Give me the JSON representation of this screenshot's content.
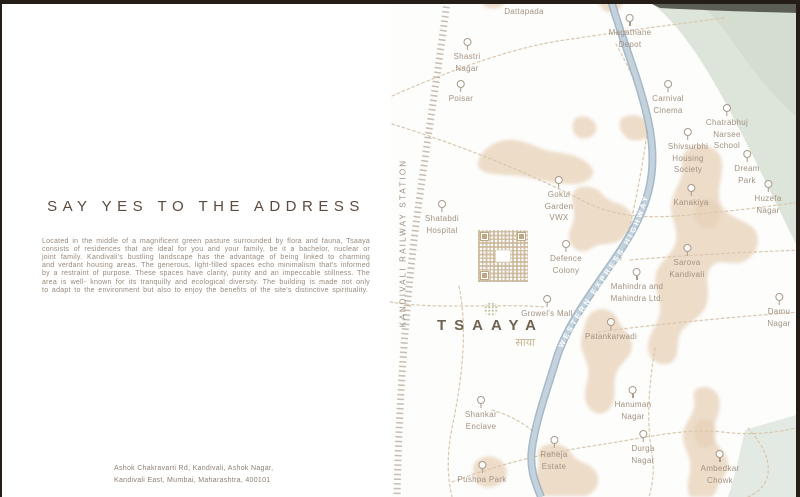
{
  "left_panel": {
    "heading": "SAY YES TO THE ADDRESS",
    "body": "Located in the middle of a magnificent green pasture surrounded by flora and fauna, Tsaaya consists of residences that are ideal for you and your family, be it a bachelor, nuclear or joint family. Kandivali's bustling landscape has the advantage of being linked to charming and verdant housing areas. The generous, light-filled spaces echo minimalism that's informed by a restraint of purpose. These spaces have clarity, purity and an impeccable stillness. The area is well- known for its tranquilly and ecological diversity. The building is made not only to adapt to the environment but also to enjoy the benefits of the site's distinctive spirituality.",
    "address_line1": "Ashok Chakravarti Rd, Kandivali, Ashok Nagar,",
    "address_line2": "Kandivali East, Mumbai, Maharashtra, 400101"
  },
  "map": {
    "station_label": "KANDIVALI RAILWAY STATION",
    "highway_label": "WESTERN EXPRESS HIGHWAY",
    "logo": {
      "name": "TSAAYA",
      "devanagari": "साया"
    },
    "icons": {
      "marker": "map-pin-icon",
      "qr": "qr-code",
      "tree": "tree-icon"
    },
    "colors": {
      "frame": "#241d18",
      "heading_text": "#5d4a3e",
      "body_text": "#98897c",
      "map_label": "#a39282",
      "road_dash": "#d9c7ae",
      "railway": "#b3a493",
      "highway_edge": "#8fa7ba",
      "highway_fill": "#c3d2dd",
      "land_patch": "#ead7c0",
      "park_green": "#dde4d9",
      "water_green": "#e2eae3"
    },
    "markers": [
      {
        "id": "dattapada",
        "label": "Dattapada"
      },
      {
        "id": "magathane-depot",
        "label": "Magathane\nDepot"
      },
      {
        "id": "shastri-nagar",
        "label": "Shastri\nNagar"
      },
      {
        "id": "poisar",
        "label": "Poisar"
      },
      {
        "id": "carnival-cinema",
        "label": "Carnival\nCinema"
      },
      {
        "id": "chatrabhuj-narsee-school",
        "label": "Chatrabhuj\nNarsee\nSchool"
      },
      {
        "id": "shivsurbhi-housing-society",
        "label": "Shivsurbhi\nHousing\nSociety"
      },
      {
        "id": "dream-park",
        "label": "Dream\nPark"
      },
      {
        "id": "kanakiya",
        "label": "Kanakiya"
      },
      {
        "id": "huzefa-nagar",
        "label": "Huzefa\nNagar"
      },
      {
        "id": "gokul-garden-vwx",
        "label": "Gokul\nGarden\nVWX"
      },
      {
        "id": "shatabdi-hospital",
        "label": "Shatabdi\nHospital"
      },
      {
        "id": "defence-colony",
        "label": "Defence\nColony"
      },
      {
        "id": "sarova-kandivali",
        "label": "Sarova\nKandivali"
      },
      {
        "id": "mahindra-and-mahindra",
        "label": "Mahindra and\nMahindra Ltd."
      },
      {
        "id": "damu-nagar",
        "label": "Damu\nNagar"
      },
      {
        "id": "growels-mall",
        "label": "Growel's Mall"
      },
      {
        "id": "patankarwadi",
        "label": "Patankarwadi"
      },
      {
        "id": "shankar-enclave",
        "label": "Shankar\nEnclave"
      },
      {
        "id": "hanuman-nagar",
        "label": "Hanuman\nNagar"
      },
      {
        "id": "raheja-estate",
        "label": "Raheja\nEstate"
      },
      {
        "id": "durga-nagar",
        "label": "Durga\nNagar"
      },
      {
        "id": "pushpa-park",
        "label": "Pushpa Park"
      },
      {
        "id": "ambedkar-chowk",
        "label": "Ambedkar\nChowk"
      }
    ]
  }
}
